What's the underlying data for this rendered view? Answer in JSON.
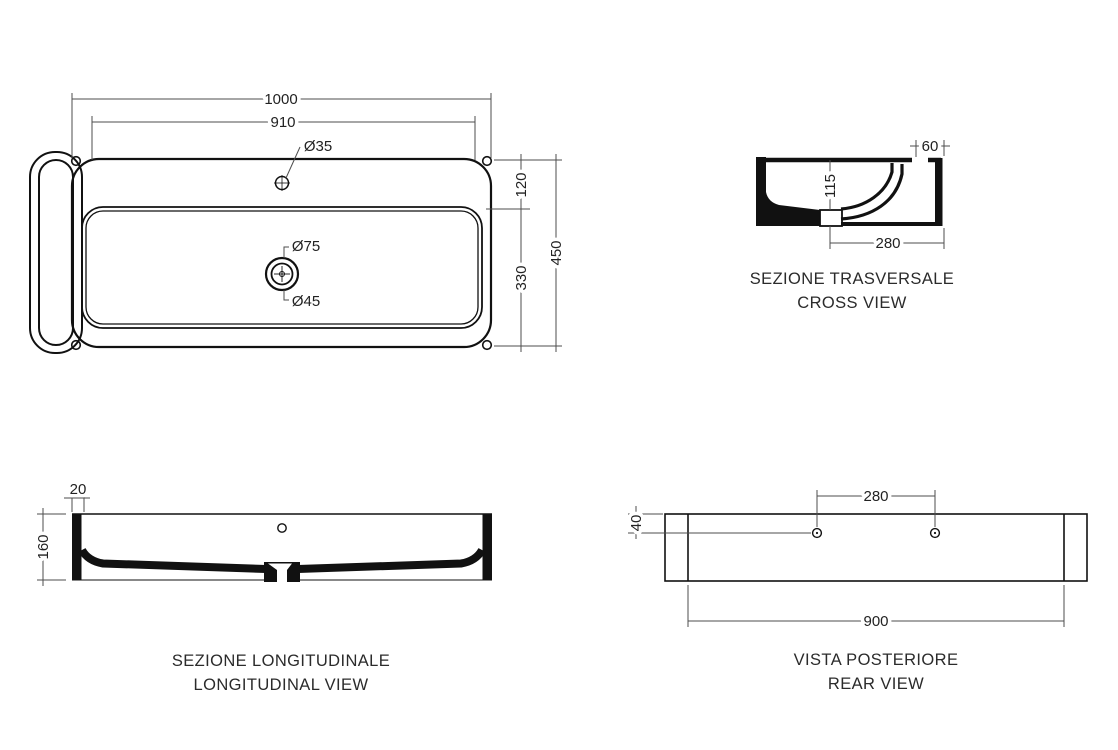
{
  "colors": {
    "line": "#111111",
    "dim_line": "#4d4d4d",
    "text": "#222222",
    "background": "#ffffff"
  },
  "views": {
    "top": {
      "dims": {
        "overall_width": "1000",
        "rim_width": "910",
        "tap_hole_dia": "Ø35",
        "drain_outer_dia": "Ø75",
        "drain_inner_dia": "Ø45",
        "deck_depth": "120",
        "bowl_depth": "330",
        "overall_depth": "450"
      }
    },
    "cross": {
      "title_primary": "SEZIONE TRASVERSALE",
      "title_secondary": "CROSS VIEW",
      "dims": {
        "tap_edge_offset": "60",
        "bowl_height": "115",
        "drain_offset": "280"
      }
    },
    "longitudinal": {
      "title_primary": "SEZIONE LONGITUDINALE",
      "title_secondary": "LONGITUDINAL VIEW",
      "dims": {
        "wall_thickness": "20",
        "overall_height": "160"
      }
    },
    "rear": {
      "title_primary": "VISTA POSTERIORE",
      "title_secondary": "REAR VIEW",
      "dims": {
        "hole_spacing": "280",
        "hole_top_offset": "40",
        "mount_width": "900"
      }
    }
  }
}
